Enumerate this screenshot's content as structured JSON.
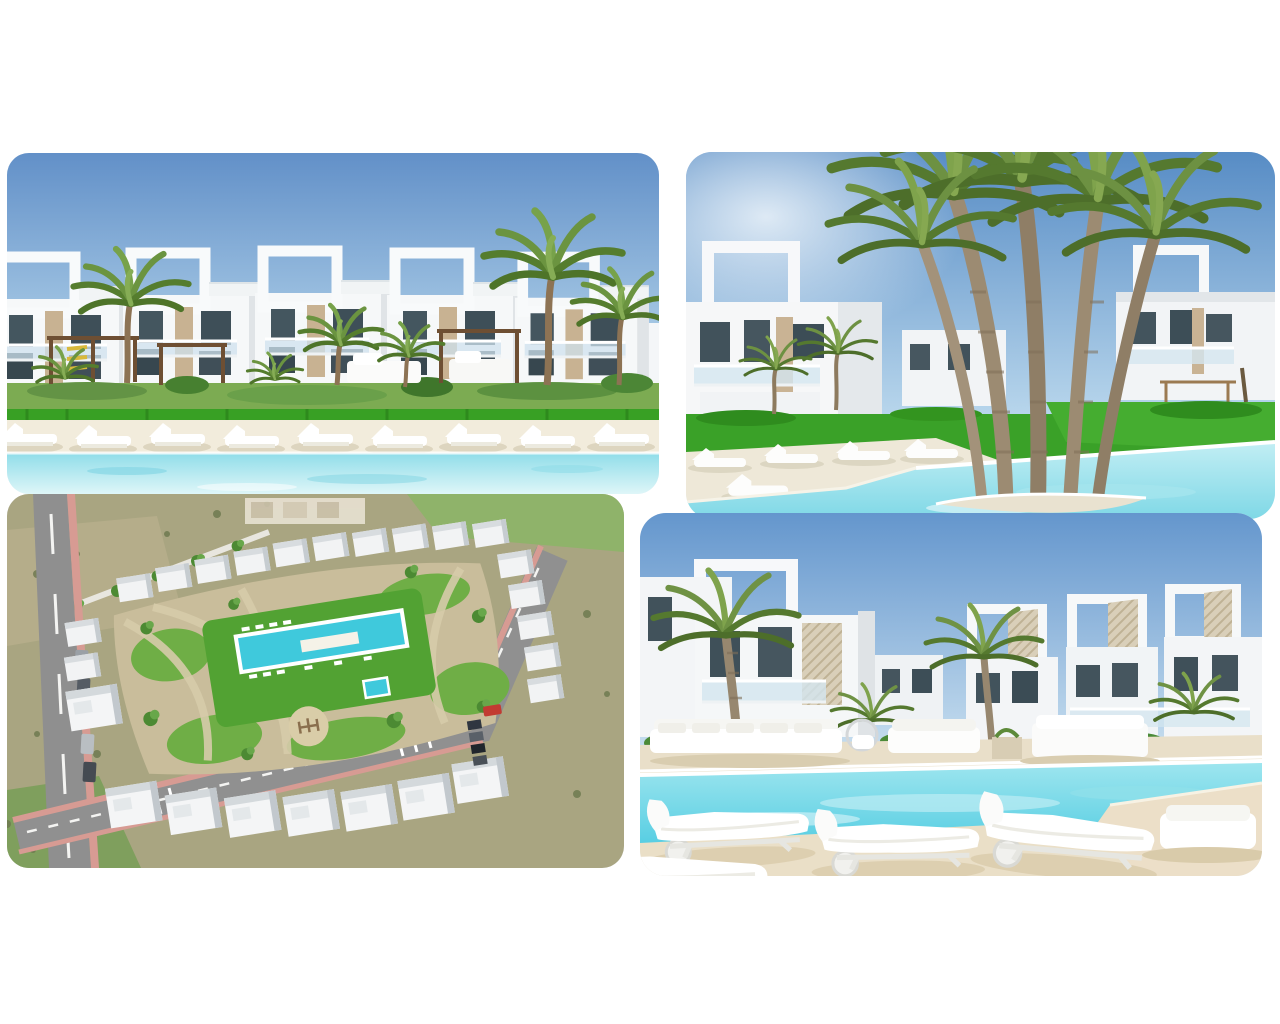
{
  "page": {
    "background_color": "#ffffff",
    "content_type": "property-photo-collage",
    "photo_count": "4"
  },
  "collage": {
    "layout": "2x2-rounded-photo-grid",
    "photos": [
      {
        "id": "photo-top-left",
        "position": "top-left",
        "description": "Render of a modern white apartment complex with rooftop cube pergolas, palm trees and gardens; a row of white sun loungers on pale sand beside a turquoise lagoon pool",
        "dominant_colors": [
          "#6290c8",
          "#f5f6f7",
          "#7cab52",
          "#9ce4ee",
          "#f2ecdc"
        ]
      },
      {
        "id": "photo-top-right",
        "position": "top-right",
        "description": "Cluster of tall palm trees on an island in a turquoise pool, white two-storey apartments and bright green lawn behind, flat white loungers on the left deck",
        "dominant_colors": [
          "#578cc5",
          "#3aa128",
          "#9c8b72",
          "#c2eef4",
          "#f4f6f8"
        ]
      },
      {
        "id": "photo-bottom-left",
        "position": "bottom-left",
        "description": "Aerial drone view of the walled development: white low-rise blocks around a landscaped park with central lawn, long turquoise pool, winding paths, playground, roads with pink sidewalks and parked cars, scrubland and green fields around",
        "dominant_colors": [
          "#a9a581",
          "#52a233",
          "#3fc9dc",
          "#8f8f8f",
          "#f2f3f4"
        ]
      },
      {
        "id": "photo-bottom-right",
        "position": "bottom-right",
        "description": "Poolside terrace with white outdoor sofas, large white sun loungers in the foreground, turquoise pool and modern white apartments with lattice cube pergolas and palms",
        "dominant_colors": [
          "#6496cd",
          "#e9dfc9",
          "#55cde2",
          "#f4f6f8",
          "#6f9244"
        ]
      }
    ]
  }
}
